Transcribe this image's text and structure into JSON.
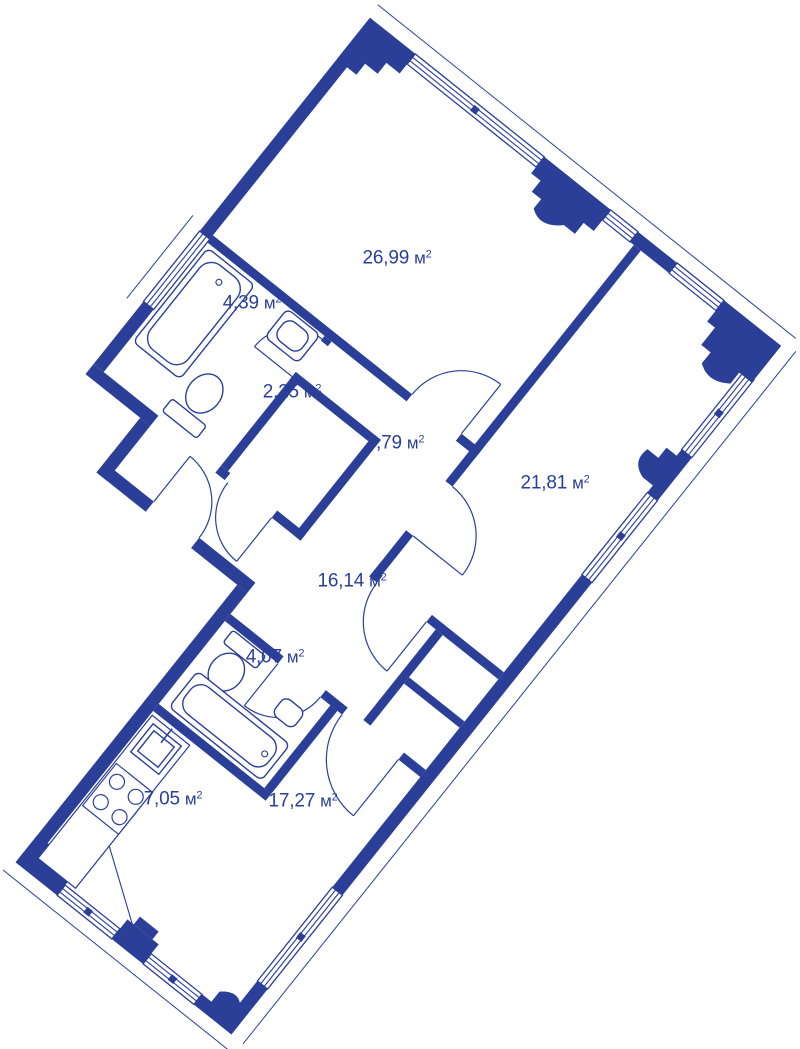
{
  "colors": {
    "ink": "#2b3f99",
    "background": "#ffffff"
  },
  "units": {
    "base": "м",
    "sup": "2"
  },
  "rooms": [
    {
      "id": "living-room",
      "area": "26,99"
    },
    {
      "id": "bathroom-main",
      "area": "4,39"
    },
    {
      "id": "closet",
      "area": "2,25"
    },
    {
      "id": "hallway-upper",
      "area": "7,79"
    },
    {
      "id": "bedroom",
      "area": "21,81"
    },
    {
      "id": "hallway-lower",
      "area": "16,14"
    },
    {
      "id": "bathroom-2nd",
      "area": "4,07"
    },
    {
      "id": "kitchen",
      "area": "7,05"
    },
    {
      "id": "living-zone",
      "area": "17,27"
    }
  ]
}
